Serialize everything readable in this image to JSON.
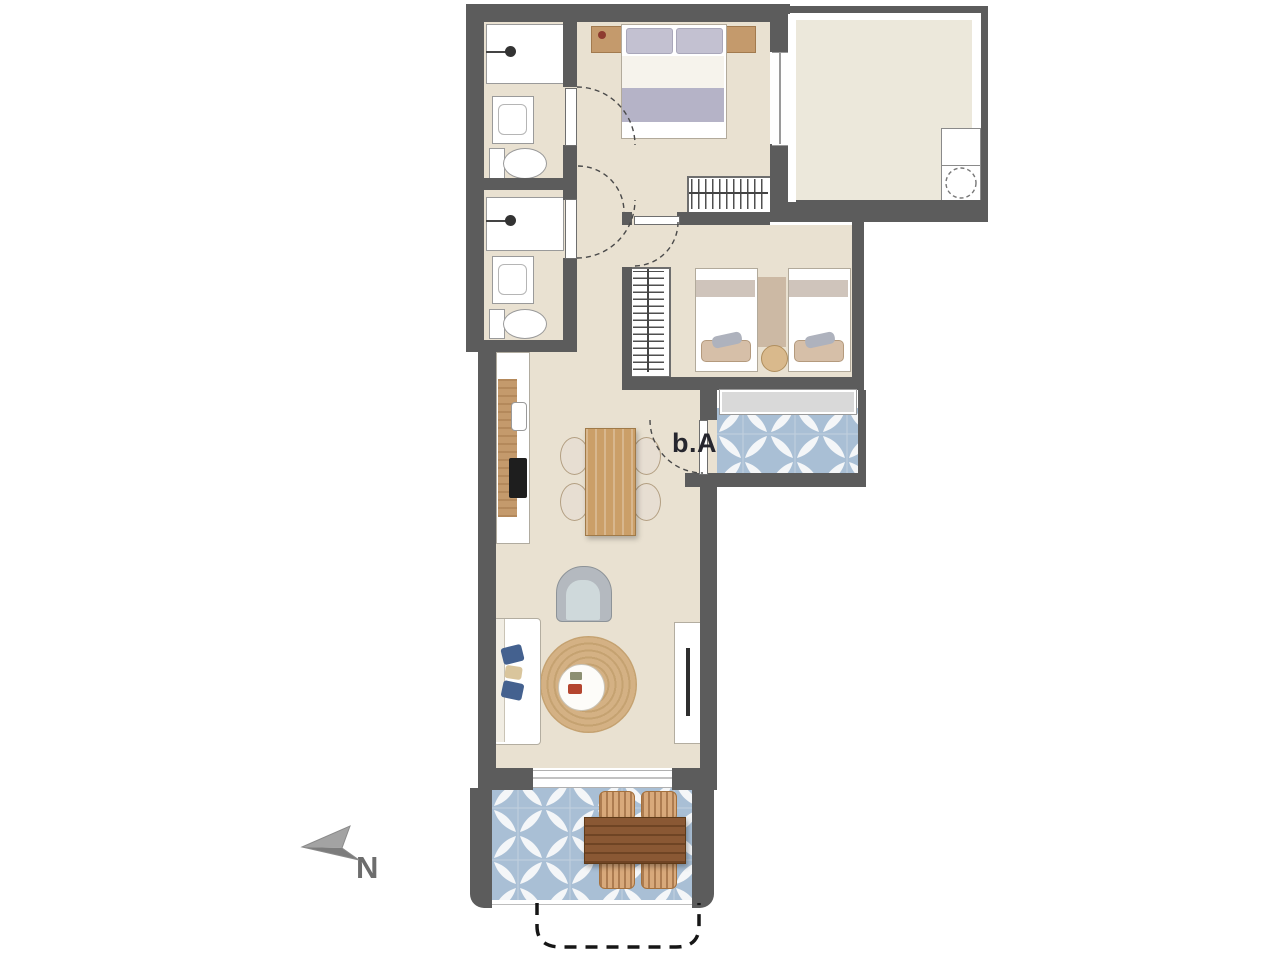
{
  "labels": {
    "unit": "b.A",
    "north": "N"
  },
  "palette": {
    "wall": "#5c5c5c",
    "floor": "#e9e1d1",
    "terrace_floor": "#ece8db",
    "tile_blue": "#a9bfd5",
    "tile_white": "#f4f6f8",
    "wood_light": "#c49a6c",
    "wood_mid": "#cb9f68",
    "wood_dark": "#8a5834",
    "wicker": "#d8a97b",
    "blanket": "#b5b3c7",
    "rug": "#d4b184",
    "pillow_blue": "#44618f",
    "armchair": "#b4b9bf",
    "glass": "#d9d9d9",
    "label_text": "#26262e",
    "north_gray": "#6d6d6d"
  }
}
